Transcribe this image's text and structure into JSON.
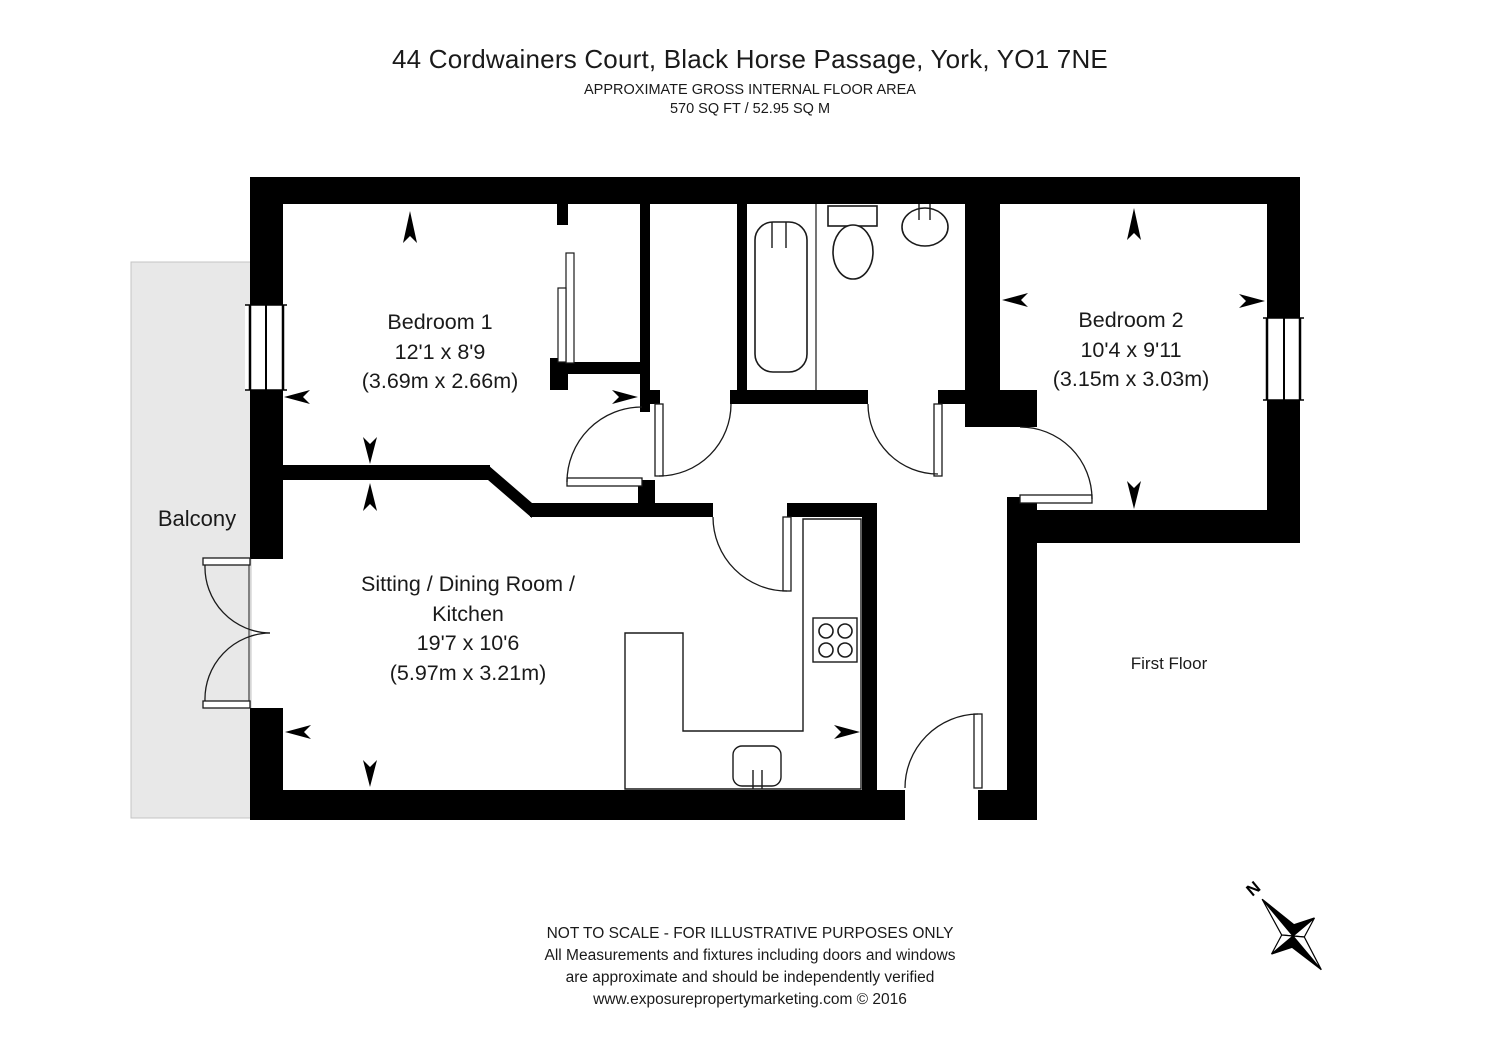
{
  "header": {
    "title": "44 Cordwainers Court, Black Horse Passage, York, YO1 7NE",
    "subtitle": "APPROXIMATE GROSS INTERNAL FLOOR AREA",
    "area": "570 SQ FT / 52.95 SQ M"
  },
  "rooms": {
    "bedroom1": {
      "name": "Bedroom 1",
      "dims_imperial": "12'1 x 8'9",
      "dims_metric": "(3.69m x 2.66m)"
    },
    "bedroom2": {
      "name": "Bedroom 2",
      "dims_imperial": "10'4 x 9'11",
      "dims_metric": "(3.15m x 3.03m)"
    },
    "sitting": {
      "name_line1": "Sitting / Dining Room /",
      "name_line2": "Kitchen",
      "dims_imperial": "19'7 x 10'6",
      "dims_metric": "(5.97m x 3.21m)"
    },
    "balcony": {
      "name": "Balcony"
    }
  },
  "floor_label": "First Floor",
  "compass": {
    "north_label": "N"
  },
  "footer": {
    "line1": "NOT TO SCALE - FOR ILLUSTRATIVE PURPOSES ONLY",
    "line2": "All Measurements and fixtures including doors and windows",
    "line3": "are approximate and should be independently verified",
    "line4": "www.exposurepropertymarketing.com © 2016"
  },
  "colors": {
    "wall": "#000000",
    "balcony_fill": "#e8e8e8",
    "line": "#1a1a1a"
  }
}
